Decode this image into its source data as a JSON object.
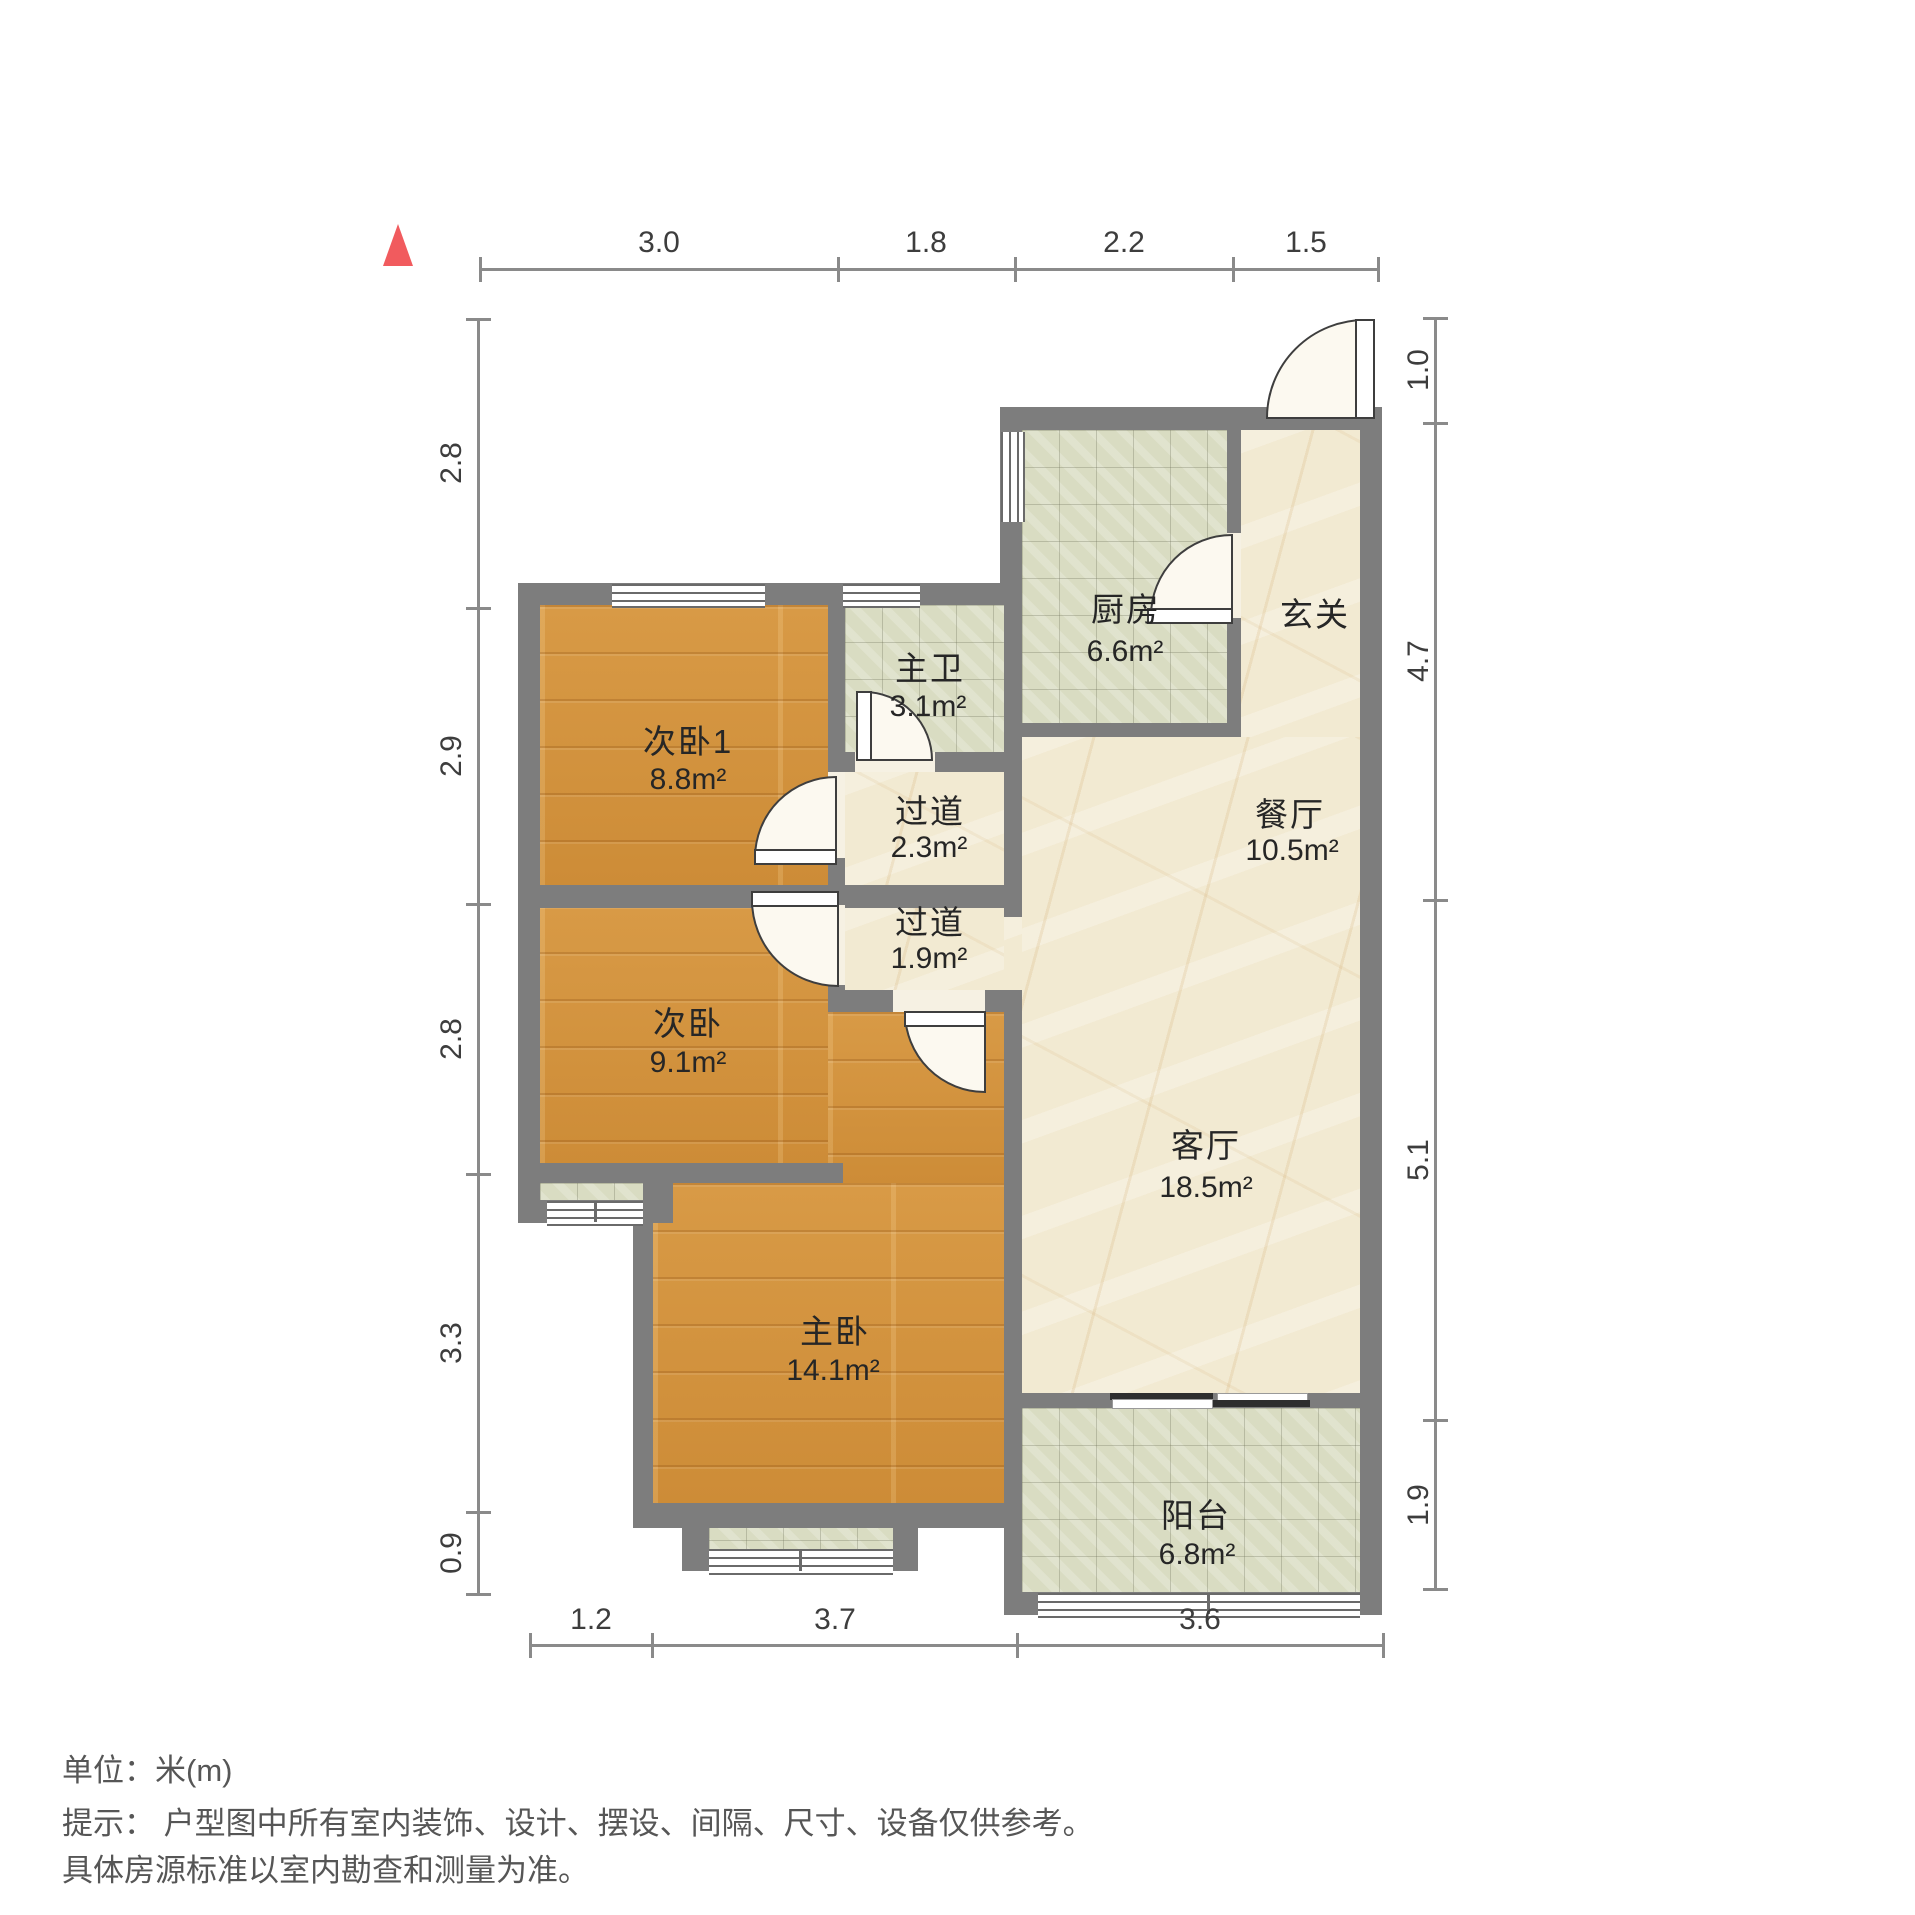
{
  "rooms": [
    {
      "name": "次卧1",
      "area": "8.8m²"
    },
    {
      "name": "主卫",
      "area": "3.1m²"
    },
    {
      "name": "厨房",
      "area": "6.6m²"
    },
    {
      "name": "玄关",
      "area": ""
    },
    {
      "name": "餐厅",
      "area": "10.5m²"
    },
    {
      "name": "过道",
      "area": "2.3m²"
    },
    {
      "name": "过道",
      "area": "1.9m²"
    },
    {
      "name": "次卧",
      "area": "9.1m²"
    },
    {
      "name": "主卧",
      "area": "14.1m²"
    },
    {
      "name": "客厅",
      "area": "18.5m²"
    },
    {
      "name": "阳台",
      "area": "6.8m²"
    }
  ],
  "dimensions": {
    "top": [
      "3.0",
      "1.8",
      "2.2",
      "1.5"
    ],
    "bottom": [
      "1.2",
      "3.7",
      "3.6"
    ],
    "left": [
      "2.8",
      "2.9",
      "2.8",
      "3.3",
      "0.9"
    ],
    "right": [
      "1.0",
      "4.7",
      "5.1",
      "1.9"
    ]
  },
  "notes": {
    "unit": "单位：米(m)",
    "tip1": "提示： 户型图中所有室内装饰、设计、摆设、间隔、尺寸、设备仅供参考。",
    "tip2": "具体房源标准以室内勘查和测量为准。"
  },
  "colors": {
    "wall": "#7d7d7d",
    "wood_floor": "#d2913c",
    "tile_floor": "#d9dcc2",
    "marble_floor": "#f2ead2",
    "north_arrow": "#f15b5e"
  }
}
